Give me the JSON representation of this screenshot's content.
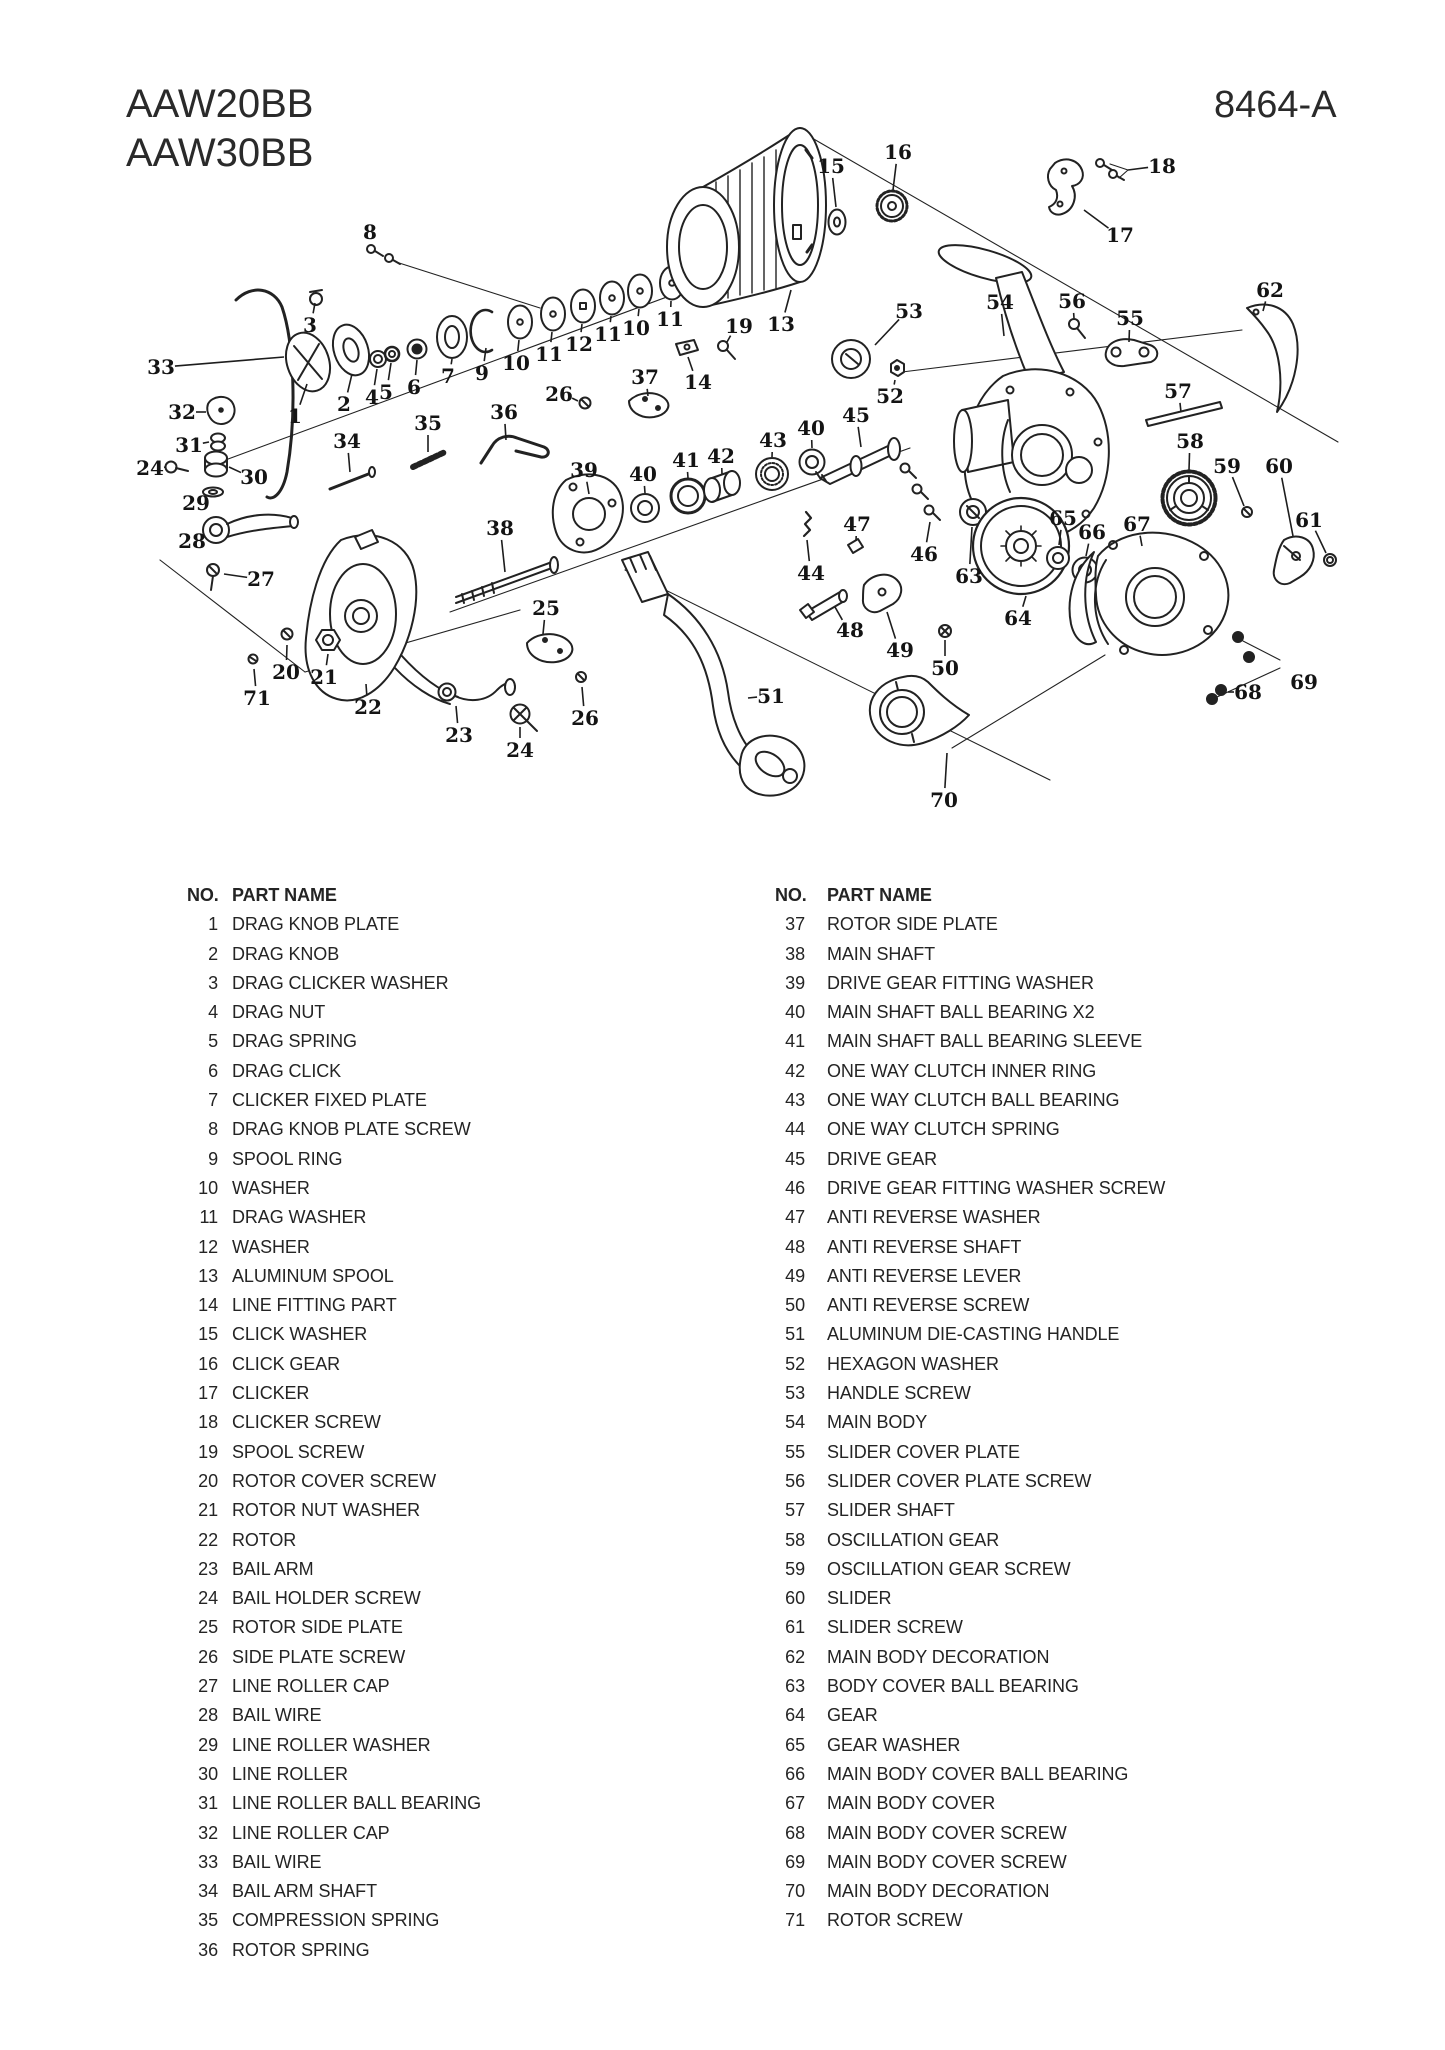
{
  "header": {
    "models": [
      "AAW20BB",
      "AAW30BB"
    ],
    "doc_number": "8464-A"
  },
  "colors": {
    "ink": "#222222",
    "paper": "#ffffff"
  },
  "parts_list": {
    "header_no": "NO.",
    "header_name": "PART NAME",
    "left": [
      {
        "no": "1",
        "name": "DRAG KNOB PLATE"
      },
      {
        "no": "2",
        "name": "DRAG KNOB"
      },
      {
        "no": "3",
        "name": "DRAG CLICKER WASHER"
      },
      {
        "no": "4",
        "name": "DRAG NUT"
      },
      {
        "no": "5",
        "name": "DRAG SPRING"
      },
      {
        "no": "6",
        "name": "DRAG CLICK"
      },
      {
        "no": "7",
        "name": "CLICKER FIXED PLATE"
      },
      {
        "no": "8",
        "name": "DRAG KNOB PLATE SCREW"
      },
      {
        "no": "9",
        "name": "SPOOL RING"
      },
      {
        "no": "10",
        "name": "WASHER"
      },
      {
        "no": "11",
        "name": "DRAG WASHER"
      },
      {
        "no": "12",
        "name": "WASHER"
      },
      {
        "no": "13",
        "name": "ALUMINUM SPOOL"
      },
      {
        "no": "14",
        "name": "LINE FITTING PART"
      },
      {
        "no": "15",
        "name": "CLICK WASHER"
      },
      {
        "no": "16",
        "name": "CLICK GEAR"
      },
      {
        "no": "17",
        "name": "CLICKER"
      },
      {
        "no": "18",
        "name": "CLICKER SCREW"
      },
      {
        "no": "19",
        "name": "SPOOL SCREW"
      },
      {
        "no": "20",
        "name": "ROTOR COVER SCREW"
      },
      {
        "no": "21",
        "name": "ROTOR NUT WASHER"
      },
      {
        "no": "22",
        "name": "ROTOR"
      },
      {
        "no": "23",
        "name": "BAIL ARM"
      },
      {
        "no": "24",
        "name": "BAIL HOLDER SCREW"
      },
      {
        "no": "25",
        "name": "ROTOR SIDE PLATE"
      },
      {
        "no": "26",
        "name": "SIDE PLATE SCREW"
      },
      {
        "no": "27",
        "name": "LINE ROLLER CAP"
      },
      {
        "no": "28",
        "name": "BAIL WIRE"
      },
      {
        "no": "29",
        "name": "LINE ROLLER WASHER"
      },
      {
        "no": "30",
        "name": "LINE ROLLER"
      },
      {
        "no": "31",
        "name": "LINE ROLLER BALL BEARING"
      },
      {
        "no": "32",
        "name": "LINE ROLLER CAP"
      },
      {
        "no": "33",
        "name": "BAIL WIRE"
      },
      {
        "no": "34",
        "name": "BAIL ARM SHAFT"
      },
      {
        "no": "35",
        "name": "COMPRESSION SPRING"
      },
      {
        "no": "36",
        "name": "ROTOR SPRING"
      }
    ],
    "right": [
      {
        "no": "37",
        "name": "ROTOR SIDE PLATE"
      },
      {
        "no": "38",
        "name": "MAIN SHAFT"
      },
      {
        "no": "39",
        "name": "DRIVE GEAR FITTING WASHER"
      },
      {
        "no": "40",
        "name": "MAIN SHAFT BALL BEARING X2"
      },
      {
        "no": "41",
        "name": "MAIN SHAFT BALL BEARING SLEEVE"
      },
      {
        "no": "42",
        "name": "ONE WAY CLUTCH INNER RING"
      },
      {
        "no": "43",
        "name": "ONE WAY CLUTCH BALL BEARING"
      },
      {
        "no": "44",
        "name": "ONE WAY CLUTCH SPRING"
      },
      {
        "no": "45",
        "name": "DRIVE GEAR"
      },
      {
        "no": "46",
        "name": "DRIVE GEAR FITTING WASHER SCREW"
      },
      {
        "no": "47",
        "name": "ANTI REVERSE WASHER"
      },
      {
        "no": "48",
        "name": "ANTI REVERSE SHAFT"
      },
      {
        "no": "49",
        "name": "ANTI REVERSE LEVER"
      },
      {
        "no": "50",
        "name": "ANTI REVERSE SCREW"
      },
      {
        "no": "51",
        "name": "ALUMINUM DIE-CASTING HANDLE"
      },
      {
        "no": "52",
        "name": "HEXAGON WASHER"
      },
      {
        "no": "53",
        "name": "HANDLE SCREW"
      },
      {
        "no": "54",
        "name": "MAIN BODY"
      },
      {
        "no": "55",
        "name": "SLIDER COVER PLATE"
      },
      {
        "no": "56",
        "name": "SLIDER COVER PLATE SCREW"
      },
      {
        "no": "57",
        "name": "SLIDER SHAFT"
      },
      {
        "no": "58",
        "name": "OSCILLATION GEAR"
      },
      {
        "no": "59",
        "name": "OSCILLATION GEAR SCREW"
      },
      {
        "no": "60",
        "name": "SLIDER"
      },
      {
        "no": "61",
        "name": "SLIDER SCREW"
      },
      {
        "no": "62",
        "name": "MAIN BODY DECORATION"
      },
      {
        "no": "63",
        "name": "BODY COVER BALL BEARING"
      },
      {
        "no": "64",
        "name": "GEAR"
      },
      {
        "no": "65",
        "name": "GEAR WASHER"
      },
      {
        "no": "66",
        "name": "MAIN BODY COVER BALL BEARING"
      },
      {
        "no": "67",
        "name": "MAIN BODY COVER"
      },
      {
        "no": "68",
        "name": "MAIN BODY COVER SCREW"
      },
      {
        "no": "69",
        "name": "MAIN BODY COVER SCREW"
      },
      {
        "no": "70",
        "name": "MAIN BODY DECORATION"
      },
      {
        "no": "71",
        "name": "ROTOR SCREW"
      }
    ]
  },
  "diagram": {
    "labels": [
      {
        "n": "1",
        "x": 295,
        "y": 416,
        "tx": 307,
        "ty": 384
      },
      {
        "n": "2",
        "x": 344,
        "y": 404,
        "tx": 352,
        "ty": 374
      },
      {
        "n": "3",
        "x": 310,
        "y": 325,
        "tx": 315,
        "ty": 303
      },
      {
        "n": "4",
        "x": 372,
        "y": 397,
        "tx": 377,
        "ty": 369
      },
      {
        "n": "5",
        "x": 386,
        "y": 392,
        "tx": 391,
        "ty": 363
      },
      {
        "n": "6",
        "x": 414,
        "y": 387,
        "tx": 417,
        "ty": 360
      },
      {
        "n": "7",
        "x": 448,
        "y": 376,
        "tx": 452,
        "ty": 359
      },
      {
        "n": "8",
        "x": 370,
        "y": 232,
        "tx": 371,
        "ty": 244
      },
      {
        "n": "9",
        "x": 482,
        "y": 373,
        "tx": 486,
        "ty": 348
      },
      {
        "n": "10",
        "x": 516,
        "y": 363,
        "tx": 519,
        "ty": 340
      },
      {
        "n": "11",
        "x": 549,
        "y": 354,
        "tx": 552,
        "ty": 332
      },
      {
        "n": "12",
        "x": 579,
        "y": 344,
        "tx": 582,
        "ty": 324
      },
      {
        "n": "11",
        "x": 608,
        "y": 334,
        "tx": 611,
        "ty": 316
      },
      {
        "n": "10",
        "x": 636,
        "y": 328,
        "tx": 639,
        "ty": 309
      },
      {
        "n": "11",
        "x": 670,
        "y": 319,
        "tx": 671,
        "ty": 301
      },
      {
        "n": "13",
        "x": 781,
        "y": 324,
        "tx": 791,
        "ty": 290
      },
      {
        "n": "14",
        "x": 698,
        "y": 382,
        "tx": 688,
        "ty": 357
      },
      {
        "n": "15",
        "x": 831,
        "y": 166,
        "tx": 836,
        "ty": 207
      },
      {
        "n": "16",
        "x": 898,
        "y": 152,
        "tx": 893,
        "ty": 190
      },
      {
        "n": "17",
        "x": 1120,
        "y": 235,
        "tx": 1084,
        "ty": 210
      },
      {
        "n": "18",
        "x": 1162,
        "y": 166,
        "tx": 1128,
        "ty": 170
      },
      {
        "n": "19",
        "x": 739,
        "y": 326,
        "tx": 727,
        "ty": 342
      },
      {
        "n": "20",
        "x": 286,
        "y": 672,
        "tx": 287,
        "ty": 645
      },
      {
        "n": "21",
        "x": 324,
        "y": 677,
        "tx": 328,
        "ty": 654
      },
      {
        "n": "22",
        "x": 368,
        "y": 707,
        "tx": 366,
        "ty": 684
      },
      {
        "n": "23",
        "x": 459,
        "y": 735,
        "tx": 456,
        "ty": 706
      },
      {
        "n": "24",
        "x": 150,
        "y": 468,
        "tx": 166,
        "ty": 467
      },
      {
        "n": "24",
        "x": 520,
        "y": 750,
        "tx": 520,
        "ty": 727
      },
      {
        "n": "25",
        "x": 546,
        "y": 608,
        "tx": 543,
        "ty": 634
      },
      {
        "n": "26",
        "x": 559,
        "y": 394,
        "tx": 578,
        "ty": 401
      },
      {
        "n": "26",
        "x": 585,
        "y": 718,
        "tx": 582,
        "ty": 687
      },
      {
        "n": "27",
        "x": 261,
        "y": 579,
        "tx": 224,
        "ty": 574
      },
      {
        "n": "28",
        "x": 192,
        "y": 541,
        "tx": 206,
        "ty": 535
      },
      {
        "n": "29",
        "x": 196,
        "y": 503,
        "tx": 205,
        "ty": 497
      },
      {
        "n": "30",
        "x": 254,
        "y": 477,
        "tx": 229,
        "ty": 467
      },
      {
        "n": "31",
        "x": 189,
        "y": 445,
        "tx": 209,
        "ty": 442
      },
      {
        "n": "32",
        "x": 182,
        "y": 412,
        "tx": 206,
        "ty": 412
      },
      {
        "n": "33",
        "x": 161,
        "y": 367,
        "tx": 284,
        "ty": 357
      },
      {
        "n": "34",
        "x": 347,
        "y": 441,
        "tx": 350,
        "ty": 472
      },
      {
        "n": "35",
        "x": 428,
        "y": 423,
        "tx": 428,
        "ty": 452
      },
      {
        "n": "36",
        "x": 504,
        "y": 412,
        "tx": 506,
        "ty": 440
      },
      {
        "n": "37",
        "x": 645,
        "y": 377,
        "tx": 648,
        "ty": 396
      },
      {
        "n": "38",
        "x": 500,
        "y": 528,
        "tx": 505,
        "ty": 572
      },
      {
        "n": "39",
        "x": 584,
        "y": 470,
        "tx": 589,
        "ty": 494
      },
      {
        "n": "40",
        "x": 643,
        "y": 474,
        "tx": 645,
        "ty": 493
      },
      {
        "n": "41",
        "x": 686,
        "y": 460,
        "tx": 688,
        "ty": 478
      },
      {
        "n": "42",
        "x": 721,
        "y": 456,
        "tx": 722,
        "ty": 474
      },
      {
        "n": "43",
        "x": 773,
        "y": 440,
        "tx": 772,
        "ty": 457
      },
      {
        "n": "40",
        "x": 811,
        "y": 428,
        "tx": 812,
        "ty": 448
      },
      {
        "n": "44",
        "x": 811,
        "y": 573,
        "tx": 807,
        "ty": 540
      },
      {
        "n": "45",
        "x": 856,
        "y": 415,
        "tx": 861,
        "ty": 447
      },
      {
        "n": "46",
        "x": 924,
        "y": 554,
        "tx": 930,
        "ty": 522
      },
      {
        "n": "47",
        "x": 857,
        "y": 524,
        "tx": 856,
        "ty": 541
      },
      {
        "n": "48",
        "x": 850,
        "y": 630,
        "tx": 835,
        "ty": 607
      },
      {
        "n": "49",
        "x": 900,
        "y": 650,
        "tx": 887,
        "ty": 612
      },
      {
        "n": "50",
        "x": 945,
        "y": 668,
        "tx": 945,
        "ty": 640
      },
      {
        "n": "51",
        "x": 771,
        "y": 696,
        "tx": 748,
        "ty": 698
      },
      {
        "n": "52",
        "x": 890,
        "y": 396,
        "tx": 895,
        "ty": 380
      },
      {
        "n": "53",
        "x": 909,
        "y": 311,
        "tx": 875,
        "ty": 345
      },
      {
        "n": "54",
        "x": 1000,
        "y": 302,
        "tx": 1004,
        "ty": 336
      },
      {
        "n": "55",
        "x": 1130,
        "y": 318,
        "tx": 1129,
        "ty": 342
      },
      {
        "n": "56",
        "x": 1072,
        "y": 301,
        "tx": 1074,
        "ty": 318
      },
      {
        "n": "57",
        "x": 1178,
        "y": 391,
        "tx": 1181,
        "ty": 412
      },
      {
        "n": "58",
        "x": 1190,
        "y": 441,
        "tx": 1189,
        "ty": 470
      },
      {
        "n": "59",
        "x": 1227,
        "y": 466,
        "tx": 1244,
        "ty": 506
      },
      {
        "n": "60",
        "x": 1279,
        "y": 466,
        "tx": 1293,
        "ty": 536
      },
      {
        "n": "61",
        "x": 1309,
        "y": 520,
        "tx": 1326,
        "ty": 553
      },
      {
        "n": "62",
        "x": 1270,
        "y": 290,
        "tx": 1263,
        "ty": 311
      },
      {
        "n": "63",
        "x": 969,
        "y": 576,
        "tx": 972,
        "ty": 527
      },
      {
        "n": "64",
        "x": 1018,
        "y": 618,
        "tx": 1026,
        "ty": 596
      },
      {
        "n": "65",
        "x": 1063,
        "y": 518,
        "tx": 1059,
        "ty": 545
      },
      {
        "n": "66",
        "x": 1092,
        "y": 532,
        "tx": 1086,
        "ty": 556
      },
      {
        "n": "67",
        "x": 1137,
        "y": 524,
        "tx": 1142,
        "ty": 546
      },
      {
        "n": "68",
        "x": 1248,
        "y": 692,
        "tx": 1228,
        "ty": 692
      },
      {
        "n": "69",
        "x": 1304,
        "y": 682,
        "tx": 1291,
        "ty": 673
      },
      {
        "n": "70",
        "x": 944,
        "y": 800,
        "tx": 947,
        "ty": 753
      },
      {
        "n": "71",
        "x": 257,
        "y": 698,
        "tx": 254,
        "ty": 669
      }
    ]
  }
}
